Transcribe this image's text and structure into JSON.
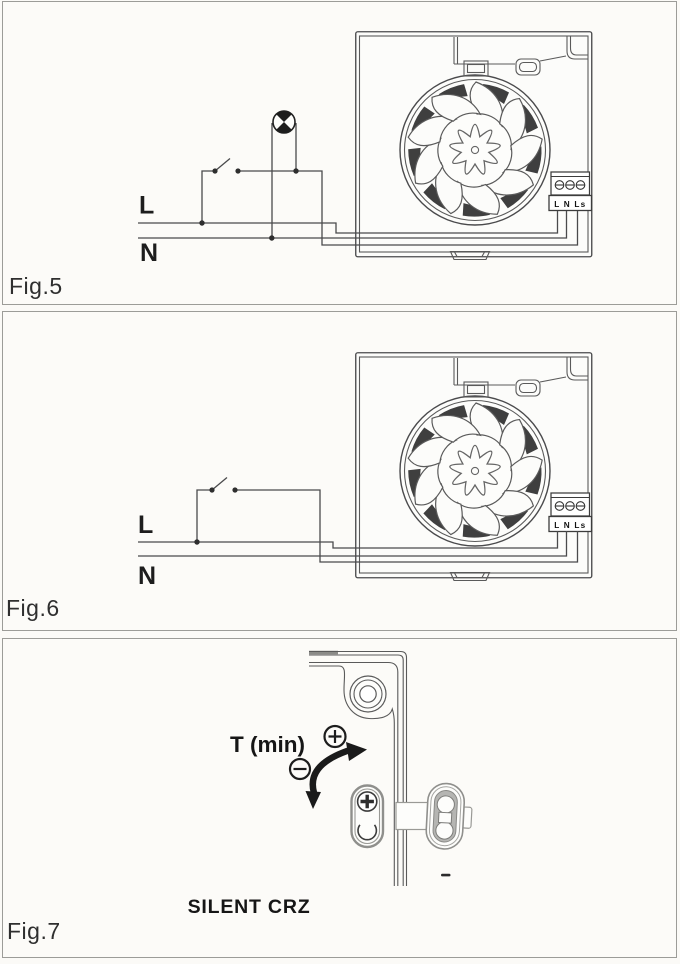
{
  "figures": {
    "fig5": {
      "label": "Fig.5",
      "supply_live_label": "L",
      "supply_neutral_label": "N"
    },
    "fig6": {
      "label": "Fig.6",
      "supply_live_label": "L",
      "supply_neutral_label": "N"
    },
    "fig7": {
      "label": "Fig.7",
      "adjustment_label": "T (min)",
      "product_name": "SILENT CRZ"
    }
  },
  "fan_unit": {
    "terminal_strip_label": "L N Ls"
  },
  "icons": {
    "lamp": "lamp-icon",
    "switch": "switch-icon",
    "terminal_screws": "screw-terminal-icons",
    "phillips_screw": "phillips-screw-icon",
    "plus": "plus-circle-icon",
    "minus": "minus-circle-icon",
    "rotate_arrow": "rotate-arrow-icon",
    "mounting_hole": "mounting-hole-icon"
  },
  "colors": {
    "paper": "#fbfaf7",
    "panel_border": "#9c9c98",
    "line": "#4a4a4c",
    "ink": "#1d1d1d",
    "metal_gray": "#b5b5b2",
    "wedge_dark": "#3f3f3f"
  }
}
